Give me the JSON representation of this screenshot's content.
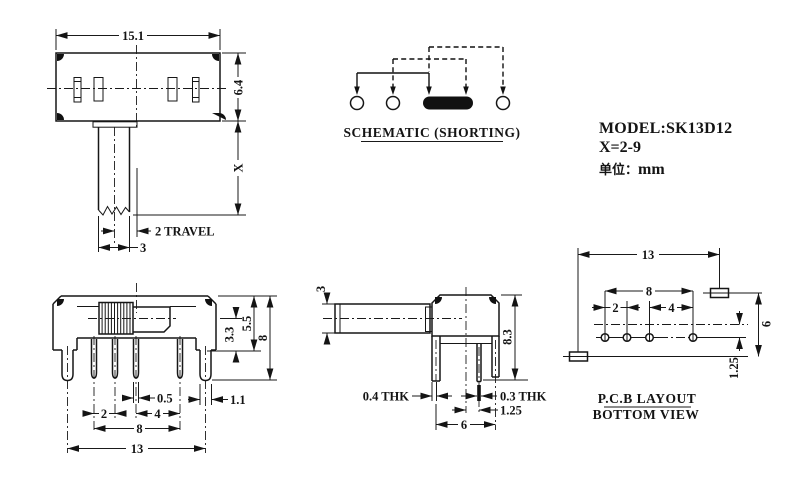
{
  "drawing": {
    "top_view": {
      "width": "15.1",
      "height": "6.4",
      "shaft_length": "X",
      "travel": "2 TRAVEL",
      "shaft_width": "3"
    },
    "schematic": {
      "title": "SCHEMATIC (SHORTING)"
    },
    "title_block": {
      "model": "MODEL:SK13D12",
      "x_range": "X=2-9",
      "unit_label": "单位：",
      "unit_value": "mm"
    },
    "front_view": {
      "knob_height": "3.3",
      "body_height": "5.5",
      "overall_height": "8",
      "pin_width": "0.5",
      "bracket_width": "1.1",
      "pin_pitch_a": "2",
      "pin_pitch_b": "4",
      "pin_span": "8",
      "bracket_span": "13"
    },
    "side_view": {
      "shaft_height": "3",
      "overall_height": "8.3",
      "bracket_thickness": "0.4 THK",
      "pin_thickness": "0.3 THK",
      "pin_offset": "1.25",
      "leg_span": "6"
    },
    "pcb_layout": {
      "slot_span": "13",
      "hole_span": "8",
      "hole_pitch_a": "2",
      "hole_pitch_b": "4",
      "row_span": "6",
      "hole_offset": "1.25",
      "title": "P.C.B LAYOUT",
      "subtitle": "BOTTOM VIEW"
    }
  }
}
